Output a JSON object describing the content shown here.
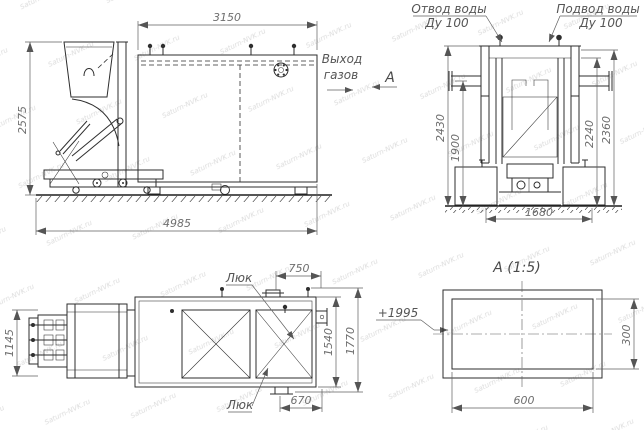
{
  "watermark": {
    "text": "Saturn-NVK.ru"
  },
  "colors": {
    "line": "#2e2e2e",
    "dim_text": "#6e6e6e",
    "label_text": "#555555",
    "background": "#ffffff"
  },
  "front_view": {
    "dims": {
      "top": "3150",
      "left": "2575",
      "bottom": "4985"
    },
    "gas_label": {
      "line1": "Выход",
      "line2": "газов"
    },
    "section_label": "А"
  },
  "side_view": {
    "labels": {
      "outlet_line1": "Отвод воды",
      "outlet_line2": "Ду 100",
      "inlet_line1": "Подвод воды",
      "inlet_line2": "Ду 100"
    },
    "dims": {
      "left_outer": "2430",
      "left_inner": "1900",
      "right_inner": "2240",
      "right_outer": "2360",
      "bottom": "1680"
    }
  },
  "plan_view": {
    "dims": {
      "left": "1145",
      "top": "750",
      "right_inner": "1540",
      "right_outer": "1770",
      "bottom": "670"
    },
    "elevation": "+1995",
    "hatch_top": "Люк",
    "hatch_bottom": "Люк"
  },
  "detail_view": {
    "title": "А (1:5)",
    "dims": {
      "width": "600",
      "height": "300"
    }
  }
}
